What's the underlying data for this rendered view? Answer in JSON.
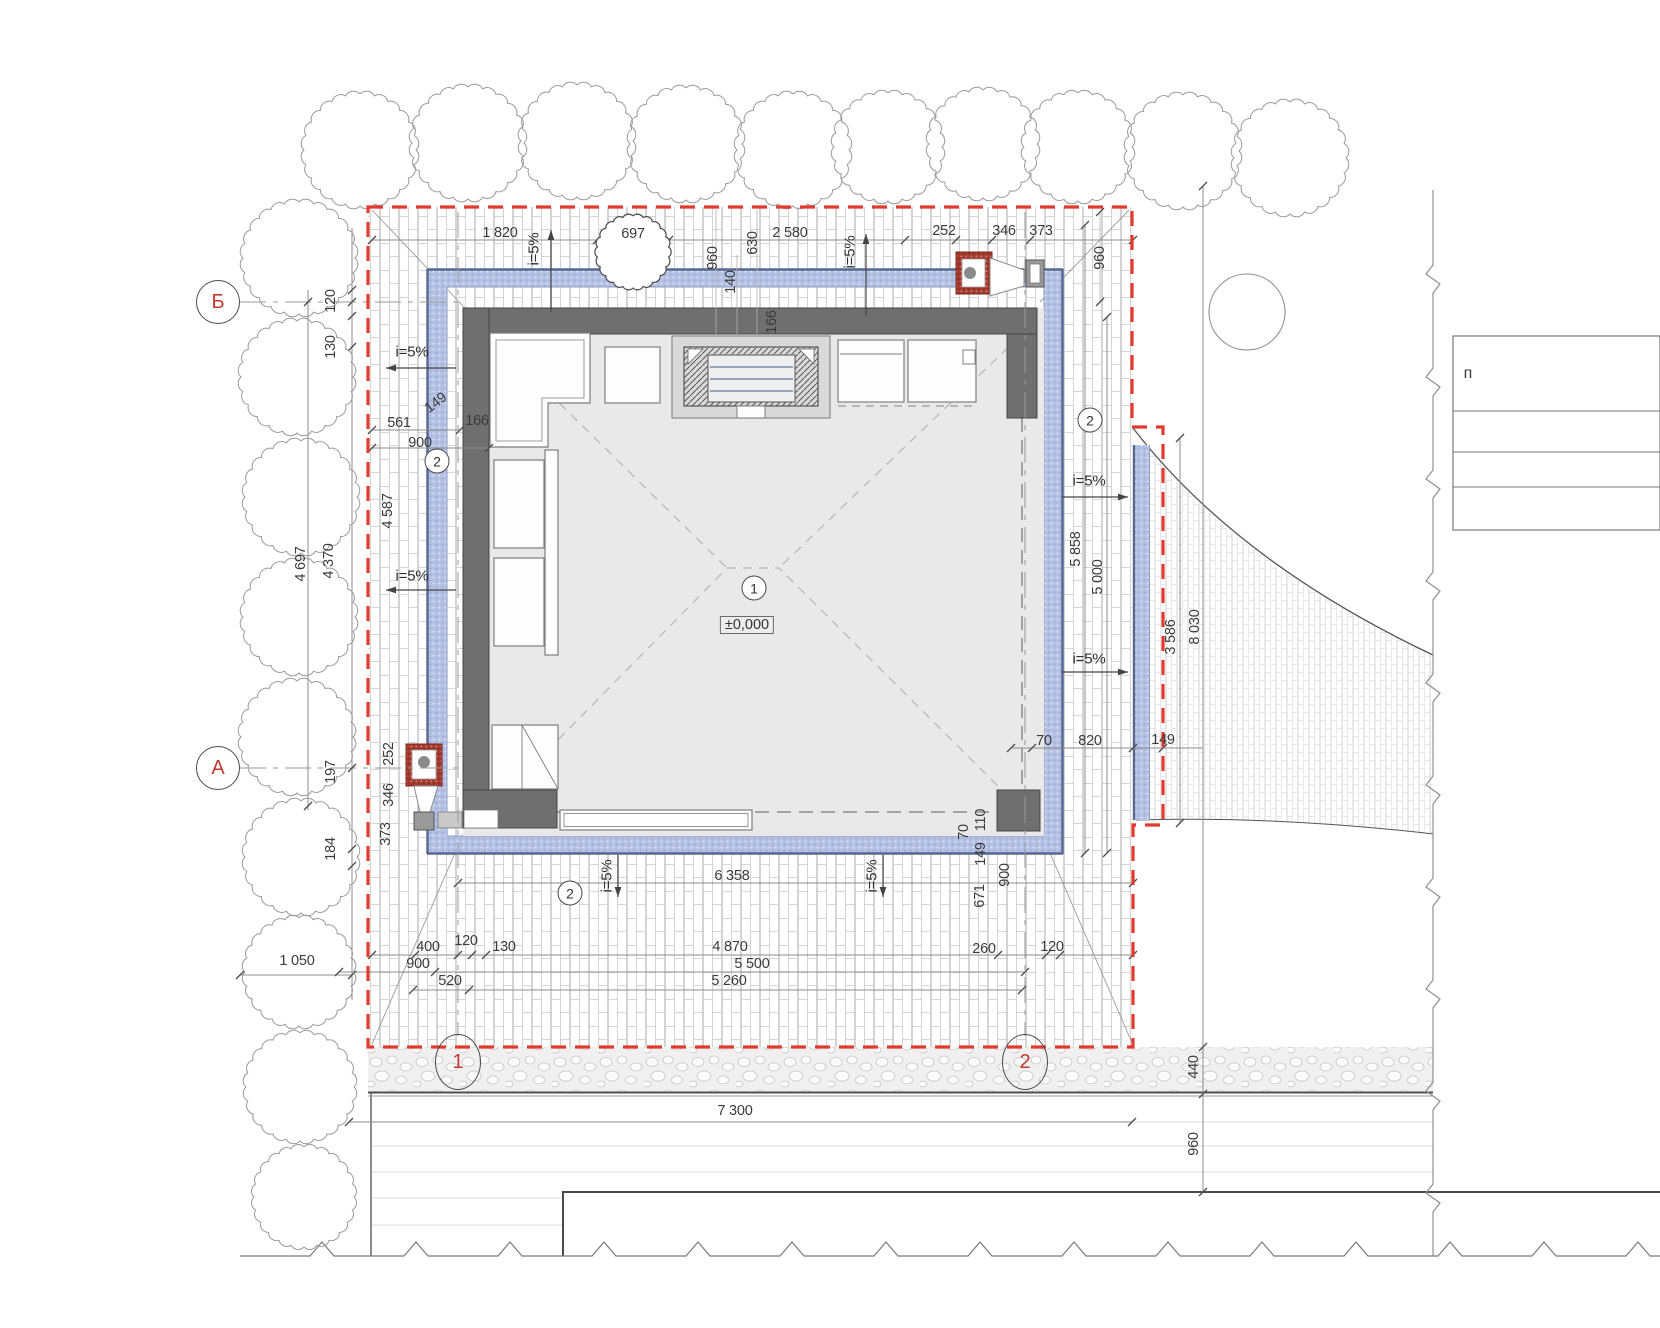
{
  "drawing": {
    "kind": "architectural site / pavilion plan",
    "boundary_color": "#e23a2e",
    "drain_band_color": "#b4c1e4",
    "wall_color": "#6f6f6f",
    "axis_text_color": "#c23b30"
  },
  "level_mark": {
    "t": "±0,000"
  },
  "room_tag": {
    "t": "1"
  },
  "legend": {
    "t": "п"
  },
  "axes": [
    {
      "t": "Б",
      "x": 218,
      "y": 302,
      "s": "c"
    },
    {
      "t": "А",
      "x": 218,
      "y": 768,
      "s": "c"
    },
    {
      "t": "1",
      "x": 458,
      "y": 1062,
      "s": "e"
    },
    {
      "t": "2",
      "x": 1025,
      "y": 1062,
      "s": "e"
    }
  ],
  "surface_tags": [
    {
      "t": "2",
      "x": 437,
      "y": 461
    },
    {
      "t": "2",
      "x": 1090,
      "y": 420
    },
    {
      "t": "2",
      "x": 570,
      "y": 893
    }
  ],
  "labels": [
    {
      "t": "1 820",
      "x": 500,
      "y": 233,
      "r": 0
    },
    {
      "t": "697",
      "x": 633,
      "y": 234,
      "r": 0
    },
    {
      "t": "2 580",
      "x": 790,
      "y": 233,
      "r": 0
    },
    {
      "t": "252",
      "x": 944,
      "y": 231,
      "r": 0
    },
    {
      "t": "346",
      "x": 1004,
      "y": 231,
      "r": 0
    },
    {
      "t": "373",
      "x": 1041,
      "y": 231,
      "r": 0
    },
    {
      "t": "960",
      "x": 713,
      "y": 258,
      "r": -90
    },
    {
      "t": "140",
      "x": 731,
      "y": 282,
      "r": -90
    },
    {
      "t": "630",
      "x": 753,
      "y": 243,
      "r": -90
    },
    {
      "t": "960",
      "x": 1100,
      "y": 258,
      "r": -90
    },
    {
      "t": "i=5%",
      "x": 534,
      "y": 249,
      "r": -90,
      "k": "slope"
    },
    {
      "t": "i=5%",
      "x": 850,
      "y": 252,
      "r": -90,
      "k": "slope"
    },
    {
      "t": "120",
      "x": 331,
      "y": 301,
      "r": -90
    },
    {
      "t": "130",
      "x": 331,
      "y": 347,
      "r": -90
    },
    {
      "t": "149",
      "x": 436,
      "y": 403,
      "r": -38
    },
    {
      "t": "561",
      "x": 399,
      "y": 423,
      "r": 0
    },
    {
      "t": "900",
      "x": 420,
      "y": 443,
      "r": 0
    },
    {
      "t": "166",
      "x": 477,
      "y": 421,
      "r": 0
    },
    {
      "t": "4 587",
      "x": 388,
      "y": 511,
      "r": -90
    },
    {
      "t": "4 697",
      "x": 301,
      "y": 564,
      "r": -90
    },
    {
      "t": "4 370",
      "x": 329,
      "y": 561,
      "r": -90
    },
    {
      "t": "i=5%",
      "x": 412,
      "y": 352,
      "r": 0,
      "k": "slope"
    },
    {
      "t": "i=5%",
      "x": 412,
      "y": 576,
      "r": 0,
      "k": "slope"
    },
    {
      "t": "197",
      "x": 331,
      "y": 772,
      "r": -90
    },
    {
      "t": "184",
      "x": 331,
      "y": 849,
      "r": -90
    },
    {
      "t": "252",
      "x": 389,
      "y": 754,
      "r": -90
    },
    {
      "t": "346",
      "x": 389,
      "y": 795,
      "r": -90
    },
    {
      "t": "373",
      "x": 386,
      "y": 834,
      "r": -90
    },
    {
      "t": "1 050",
      "x": 297,
      "y": 961,
      "r": 0
    },
    {
      "t": "166",
      "x": 772,
      "y": 322,
      "r": -90
    },
    {
      "t": "i=5%",
      "x": 1089,
      "y": 481,
      "r": 0,
      "k": "slope"
    },
    {
      "t": "i=5%",
      "x": 1089,
      "y": 659,
      "r": 0,
      "k": "slope"
    },
    {
      "t": "5 858",
      "x": 1076,
      "y": 549,
      "r": -90
    },
    {
      "t": "5 000",
      "x": 1098,
      "y": 577,
      "r": -90
    },
    {
      "t": "3 586",
      "x": 1171,
      "y": 637,
      "r": -90
    },
    {
      "t": "8 030",
      "x": 1195,
      "y": 627,
      "r": -90
    },
    {
      "t": "70",
      "x": 1044,
      "y": 741,
      "r": 0
    },
    {
      "t": "820",
      "x": 1090,
      "y": 741,
      "r": 0
    },
    {
      "t": "149",
      "x": 1163,
      "y": 740,
      "r": 0
    },
    {
      "t": "6 358",
      "x": 732,
      "y": 876,
      "r": 0
    },
    {
      "t": "i=5%",
      "x": 607,
      "y": 876,
      "r": -90,
      "k": "slope"
    },
    {
      "t": "i=5%",
      "x": 872,
      "y": 876,
      "r": -90,
      "k": "slope"
    },
    {
      "t": "70",
      "x": 964,
      "y": 832,
      "r": -90
    },
    {
      "t": "110",
      "x": 981,
      "y": 820,
      "r": -90
    },
    {
      "t": "149",
      "x": 981,
      "y": 854,
      "r": -90
    },
    {
      "t": "900",
      "x": 1005,
      "y": 875,
      "r": -90
    },
    {
      "t": "671",
      "x": 980,
      "y": 896,
      "r": -90
    },
    {
      "t": "400",
      "x": 428,
      "y": 947,
      "r": 0
    },
    {
      "t": "120",
      "x": 466,
      "y": 941,
      "r": 0
    },
    {
      "t": "130",
      "x": 504,
      "y": 947,
      "r": 0
    },
    {
      "t": "4 870",
      "x": 730,
      "y": 947,
      "r": 0
    },
    {
      "t": "900",
      "x": 418,
      "y": 964,
      "r": 0
    },
    {
      "t": "5 500",
      "x": 752,
      "y": 964,
      "r": 0
    },
    {
      "t": "520",
      "x": 450,
      "y": 981,
      "r": 0
    },
    {
      "t": "5 260",
      "x": 729,
      "y": 981,
      "r": 0
    },
    {
      "t": "260",
      "x": 984,
      "y": 949,
      "r": 0
    },
    {
      "t": "120",
      "x": 1052,
      "y": 947,
      "r": 0
    },
    {
      "t": "7 300",
      "x": 735,
      "y": 1111,
      "r": 0
    },
    {
      "t": "440",
      "x": 1194,
      "y": 1067,
      "r": -90
    },
    {
      "t": "960",
      "x": 1194,
      "y": 1144,
      "r": -90
    }
  ]
}
